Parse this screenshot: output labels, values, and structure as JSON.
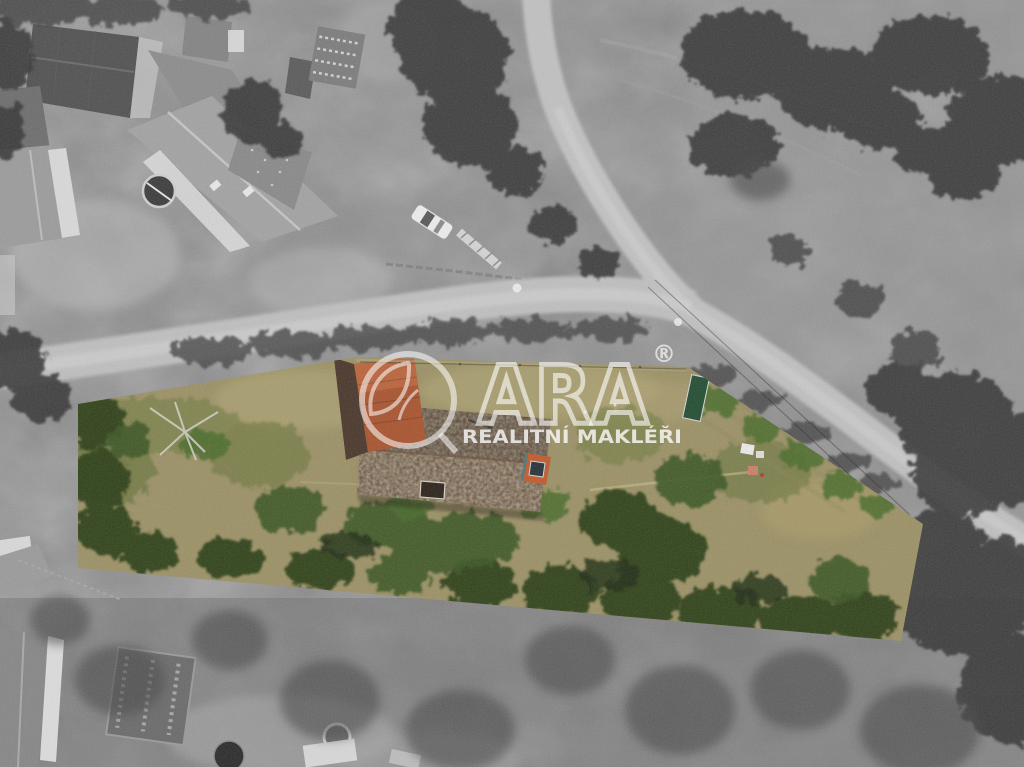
{
  "watermark": {
    "brand": "QARA",
    "brand_visible_letters": "ARA",
    "registered_mark": "®",
    "tagline": "REALITNÍ MAKLÉŘI",
    "color": "#ffffff"
  },
  "palette": {
    "field_gray": "#8d8d8d",
    "canopy_dark": "#383838",
    "road_gray": "#bfbfbf",
    "parcel_grass_dry": "#9c9166",
    "parcel_grass_green": "#5f7036",
    "parcel_bush_dark": "#2c4019",
    "roof_main_brown": "#5a4132",
    "roof_moss": "#b8b585",
    "roof_red_orange": "#a8542f",
    "dormer_orange": "#c05a2e",
    "white_structures": "#ededed"
  }
}
